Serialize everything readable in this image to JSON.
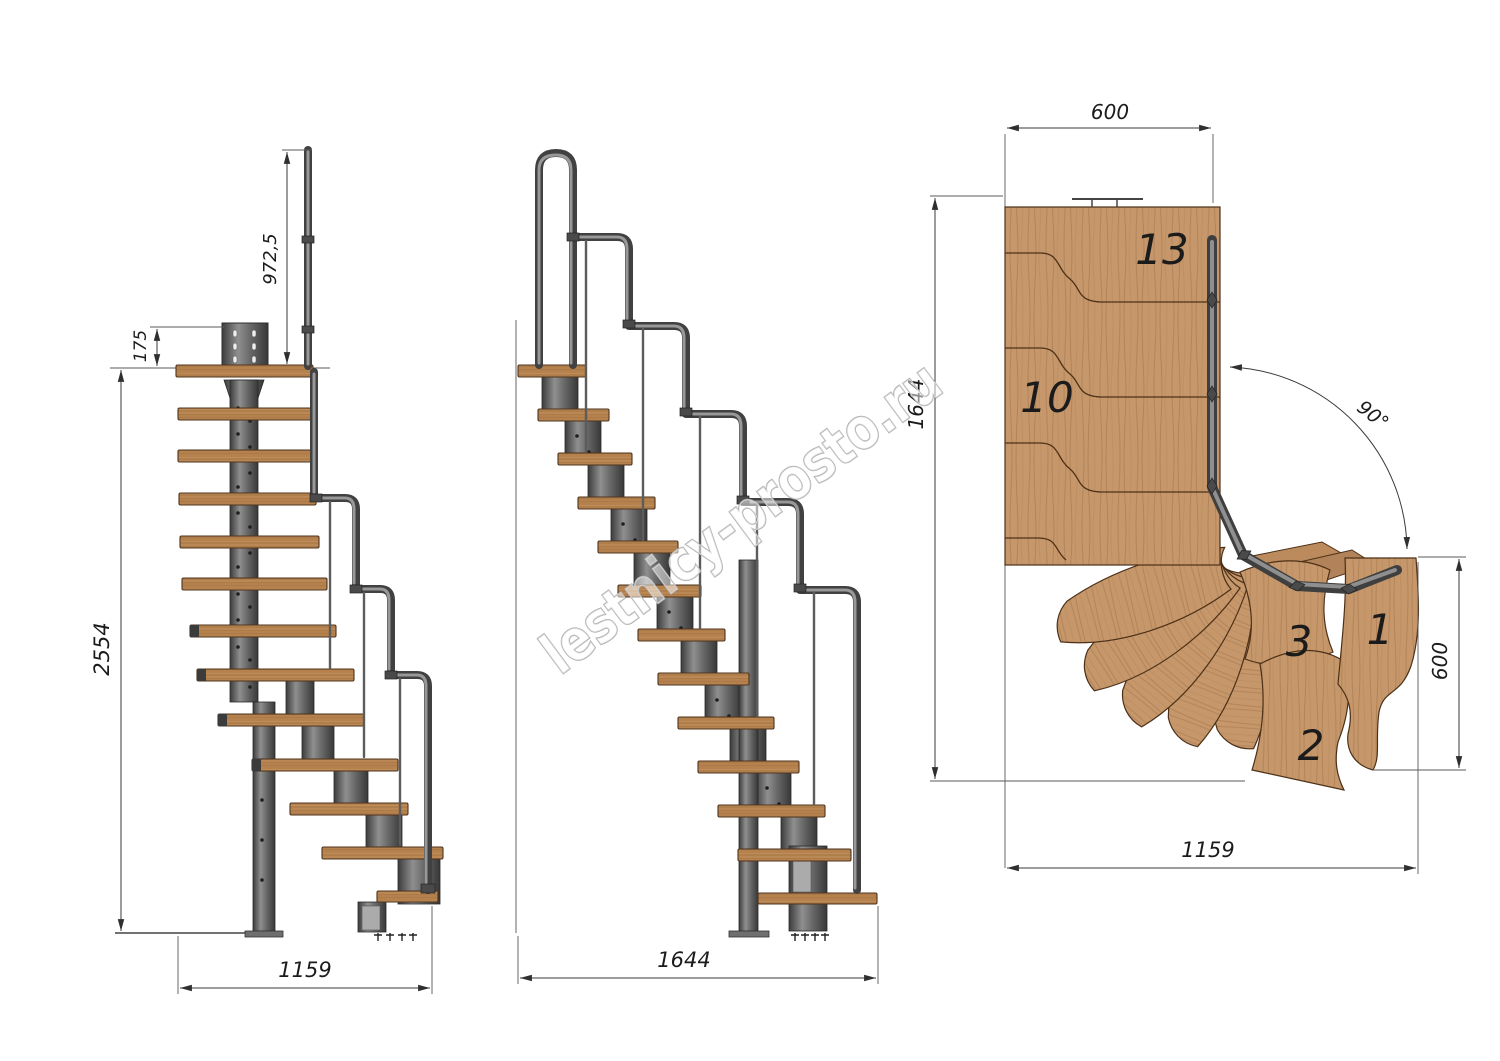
{
  "watermark": {
    "text": "lestnicy-prosto.ru"
  },
  "colors": {
    "background": "#ffffff",
    "wood": "#c6976a",
    "wood_outline": "#4c3118",
    "metal_dark": "#414141",
    "metal_light": "#989898",
    "drawing_line": "#3a3a3a",
    "dimension_text": "#1b1b1b",
    "watermark_gray": "#b0b0b0"
  },
  "views": {
    "front_elevation": {
      "dimensions": {
        "handrail_height": "972,5",
        "plate_offset": "175",
        "total_height": "2554",
        "base_width": "1159"
      }
    },
    "side_elevation": {
      "dimensions": {
        "total_length": "1644"
      }
    },
    "plan": {
      "dimensions": {
        "top_width": "600",
        "left_depth": "1644",
        "turn_angle": "90°",
        "right_width": "600",
        "bottom_length": "1159"
      },
      "step_labels": {
        "top_step": "13",
        "mid_step": "10",
        "third_step": "3",
        "first_step": "1",
        "second_step": "2"
      }
    }
  }
}
